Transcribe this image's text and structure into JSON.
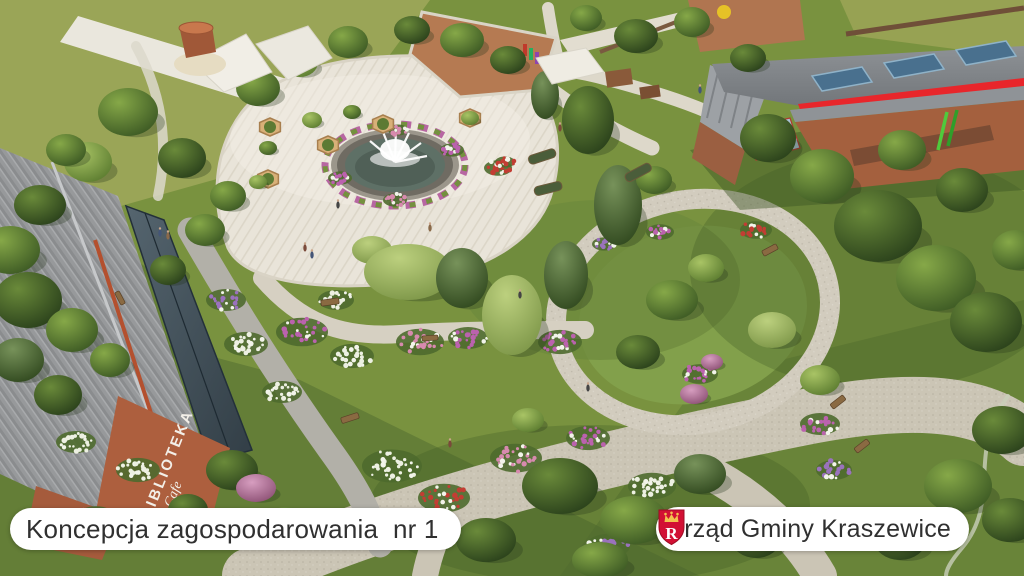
{
  "slide": {
    "concept_label": "Koncepcja zagospodarowania  nr 1",
    "office_name": "Urząd Gminy Kraszewice",
    "crest_letter": "R"
  },
  "scene": {
    "library_sign": "BIBLIOTEKA",
    "library_sign_script": "Cafe"
  },
  "colors": {
    "roof_accent_red": "#e8262b",
    "crest_red": "#d21034",
    "crest_gold": "#f2c14e",
    "pill_background": "#ffffff",
    "pill_text": "#303030"
  }
}
